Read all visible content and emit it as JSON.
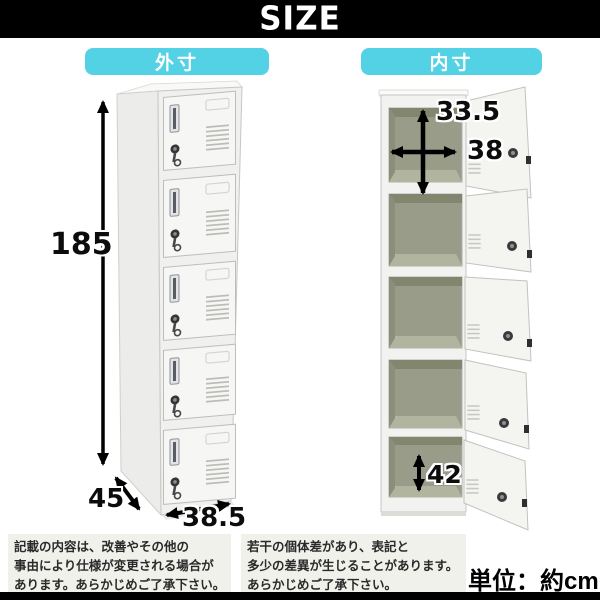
{
  "header": {
    "title": "SIZE"
  },
  "sections": {
    "outer": {
      "label": "外寸"
    },
    "inner": {
      "label": "内寸"
    }
  },
  "dimensions": {
    "outer": {
      "height": "185",
      "depth": "45",
      "width": "38.5"
    },
    "inner": {
      "top_vertical": "33.5",
      "top_horizontal": "38",
      "bottom_vertical": "42"
    }
  },
  "notes": {
    "left": [
      "記載の内容は、改善やその他の",
      "事由により仕様が変更される場合が",
      "あります。あらかじめご了承下さい。"
    ],
    "right": [
      "若干の個体差があり、表記と",
      "多少の差異が生じることがあります。",
      "あらかじめご了承下さい。"
    ],
    "unit": "単位：約cm"
  },
  "colors": {
    "accent": "#53d1e5",
    "header_bg": "#000000",
    "footer_bg": "#000000",
    "note_bg": "#eff1ea",
    "interior": "#989c88"
  }
}
